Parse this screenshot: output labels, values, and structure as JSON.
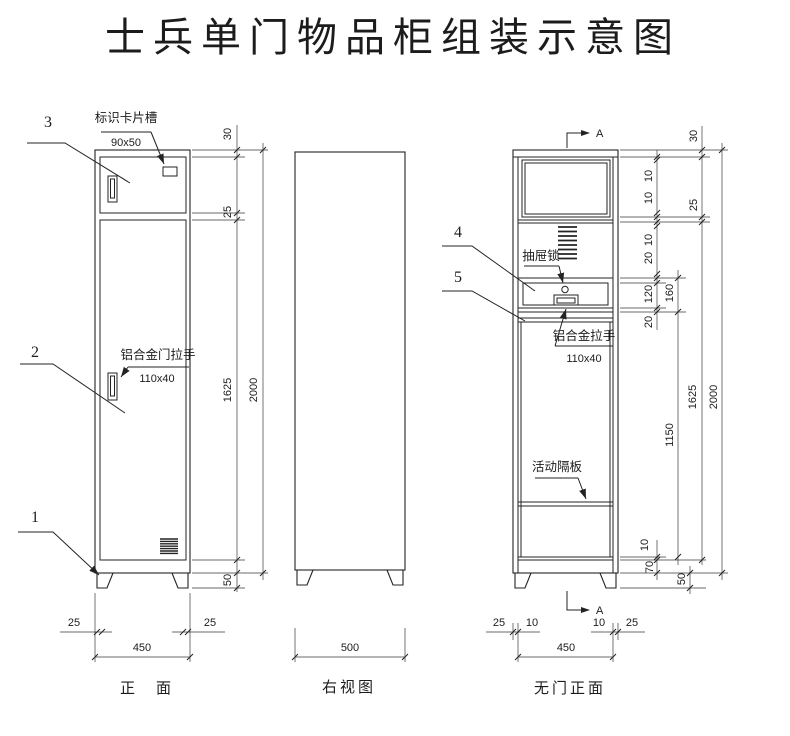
{
  "title": "士兵单门物品柜组装示意图",
  "views": {
    "front": {
      "caption": "正　面",
      "parts": {
        "p1": "1",
        "p2": "2",
        "p3": "3"
      },
      "annotations": {
        "card_slot": "标识卡片槽",
        "card_slot_size": "90x50",
        "door_handle": "铝合金门拉手",
        "door_handle_size": "110x40"
      },
      "dims": {
        "d30": "30",
        "d25": "25",
        "d1625": "1625",
        "d2000": "2000",
        "d50": "50",
        "b25l": "25",
        "b450": "450",
        "b25r": "25"
      }
    },
    "side": {
      "caption": "右视图",
      "dims": {
        "b500": "500"
      }
    },
    "nodoor": {
      "caption": "无门正面",
      "parts": {
        "p4": "4",
        "p5": "5"
      },
      "annotations": {
        "drawer_lock": "抽屉锁",
        "drawer_handle": "铝合金拉手",
        "drawer_handle_size": "110x40",
        "shelf": "活动隔板",
        "section_top": "A",
        "section_bottom": "A"
      },
      "dims": {
        "d30": "30",
        "d10a": "10",
        "d10b": "10",
        "d25": "25",
        "d10c": "10",
        "d20a": "20",
        "d120": "120",
        "d160": "160",
        "d20b": "20",
        "d1150": "1150",
        "d1625": "1625",
        "d2000": "2000",
        "d10d": "10",
        "d70": "70",
        "d50": "50",
        "b25l": "25",
        "b10l": "10",
        "b10r": "10",
        "b25r": "25",
        "b450": "450"
      }
    }
  }
}
